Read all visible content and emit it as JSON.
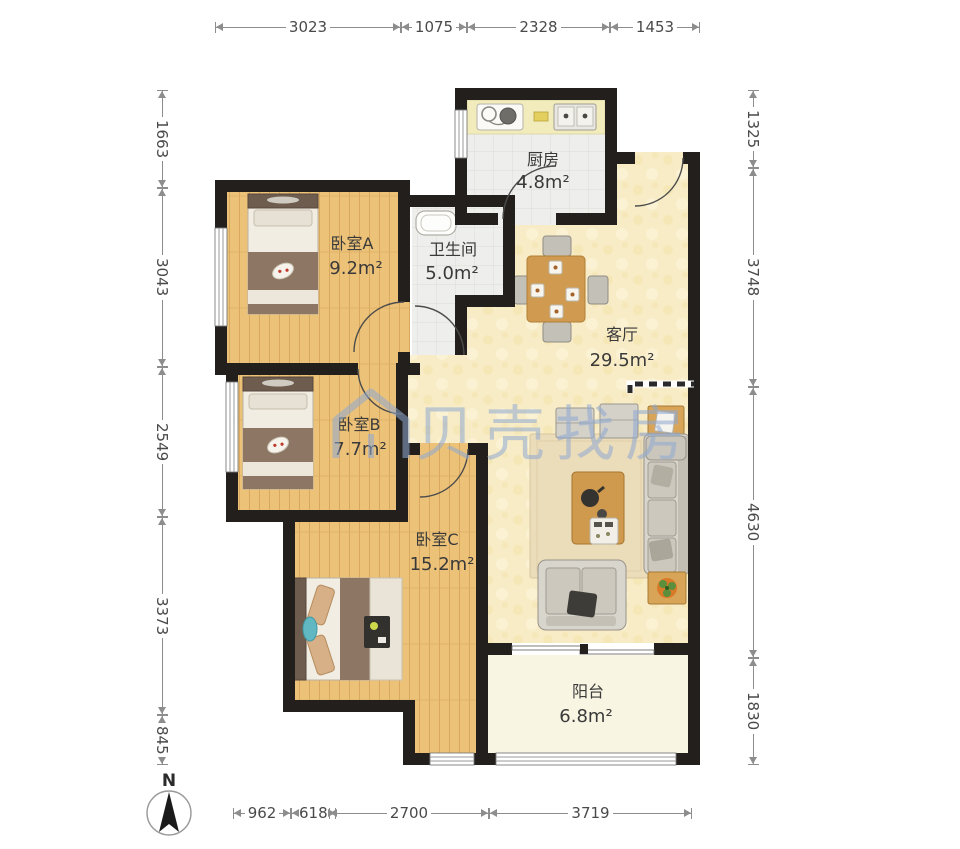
{
  "title": "户型图",
  "watermark": {
    "text": "贝壳找房"
  },
  "compass": {
    "label": "N"
  },
  "rooms": {
    "kitchen": {
      "name": "厨房",
      "area": "4.8m²"
    },
    "bathroom": {
      "name": "卫生间",
      "area": "5.0m²"
    },
    "bedroom_a": {
      "name": "卧室A",
      "area": "9.2m²"
    },
    "bedroom_b": {
      "name": "卧室B",
      "area": "7.7m²"
    },
    "bedroom_c": {
      "name": "卧室C",
      "area": "15.2m²"
    },
    "living": {
      "name": "客厅",
      "area": "29.5m²"
    },
    "balcony": {
      "name": "阳台",
      "area": "6.8m²"
    }
  },
  "dimensions": {
    "top": [
      "3023",
      "1075",
      "2328",
      "1453"
    ],
    "left": [
      "1663",
      "3043",
      "2549",
      "3373",
      "845"
    ],
    "right": [
      "1325",
      "3748",
      "4630",
      "1830"
    ],
    "bottom": [
      "962",
      "618",
      "2700",
      "3719"
    ]
  },
  "colors": {
    "wall": "#221f1c",
    "wood_floor": "#ecc279",
    "living_floor": "#f8ecc6",
    "tile_floor": "#eeeeec",
    "balcony_floor": "#f8f5e3",
    "watermark": "#8fa9d2",
    "dim_text": "#4a4a4a"
  }
}
